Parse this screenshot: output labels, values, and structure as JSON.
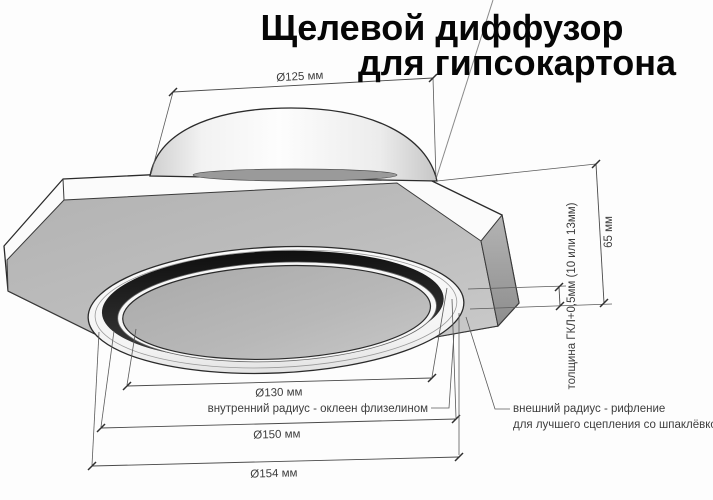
{
  "title": {
    "line1": "Щелевой диффузор",
    "line2": "для гипсокартона"
  },
  "dimensions": {
    "duct_diameter": "Ø125 мм",
    "inner_disc_diameter": "Ø130 мм",
    "slot_diameter": "Ø150 мм",
    "outer_diameter": "Ø154 мм",
    "height": "65 мм",
    "board_thickness": "толщина ГКЛ+0,5мм (10 или 13мм)"
  },
  "notes": {
    "inner_radius": "внутренний радиус - оклеен флизелином",
    "outer_radius_line1": "внешний радиус - рифление",
    "outer_radius_line2": "для лучшего сцепления со шпаклёвкой"
  },
  "colors": {
    "background": "#fdfdfd",
    "line_color": "#4a4a4a",
    "outline_color": "#2b2b2b",
    "slot_dark": "#1b1b1b",
    "disc_gray": "#b5b5b5",
    "plate_gray": "#b9b9b9",
    "text_dark": "#3d3d3d",
    "title_black": "#060606"
  }
}
